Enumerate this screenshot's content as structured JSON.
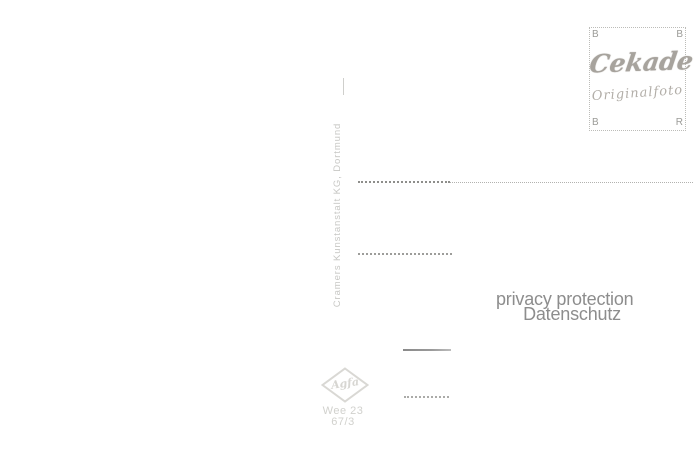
{
  "card": {
    "background": "#ffffff"
  },
  "publisher_imprint": {
    "text": "Cramers Kunstanstalt KG, Dortmund"
  },
  "stamp_box": {
    "corners": {
      "top_left": "B",
      "top_right": "B",
      "bottom_left": "B",
      "bottom_right": "R"
    },
    "brand": "Cekade",
    "subtitle": "Originalfoto"
  },
  "watermark": {
    "line1": "privacy protection",
    "line2": "Datenschutz"
  },
  "film_logo": {
    "brand": "Agfa"
  },
  "print_code": {
    "line1": "Wee 23",
    "line2": "67/3"
  },
  "colors": {
    "imprint_text": "#c7c7c4",
    "stamp_border": "#bcbcb8",
    "stamp_corner_letters": "#9b9b97",
    "stamp_brand": "#a7a39d",
    "stamp_subtitle": "#b2aea8",
    "address_line_dark": "#8e8e8b",
    "address_line_light": "#b2b2af",
    "watermark_text": "#8d8d8d",
    "agfa_logo": "#d9d8d4",
    "print_code_text": "#d1d1cd"
  }
}
